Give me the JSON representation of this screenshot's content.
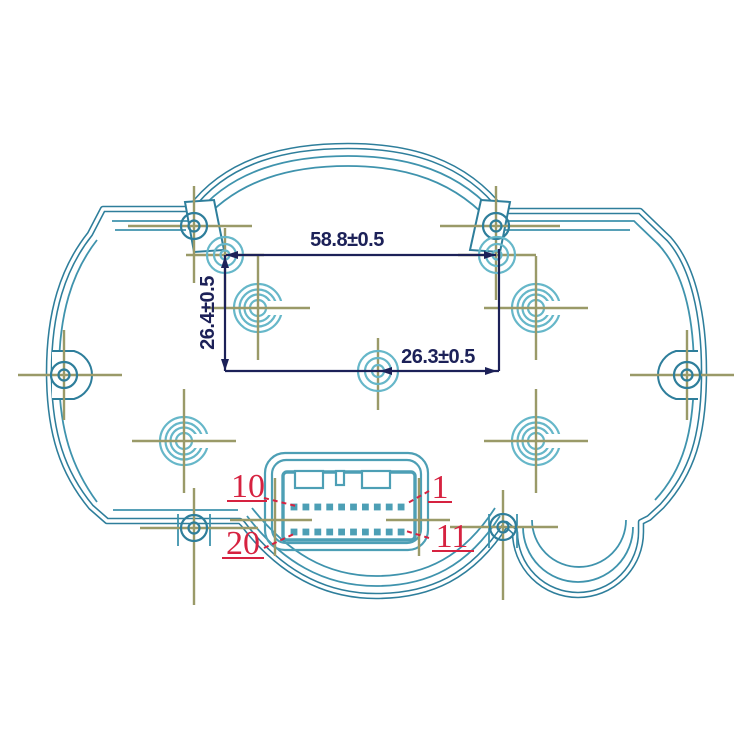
{
  "colors": {
    "background": "#ffffff",
    "outline": "#2e7e9b",
    "outline_inner": "#3f93ad",
    "connector": "#4d9fb5",
    "boss": "#66b7c9",
    "crosshair": "#9a9a68",
    "dimension": "#1c2158",
    "pin_label": "#d62240"
  },
  "dimensions": {
    "width": "58.8±0.5",
    "height": "26.4±0.5",
    "center_offset": "26.3±0.5"
  },
  "connector": {
    "rows": 2,
    "pins_per_row": 10,
    "pin_labels": {
      "top_left": "10",
      "top_right": "1",
      "bottom_left": "20",
      "bottom_right": "11"
    }
  }
}
